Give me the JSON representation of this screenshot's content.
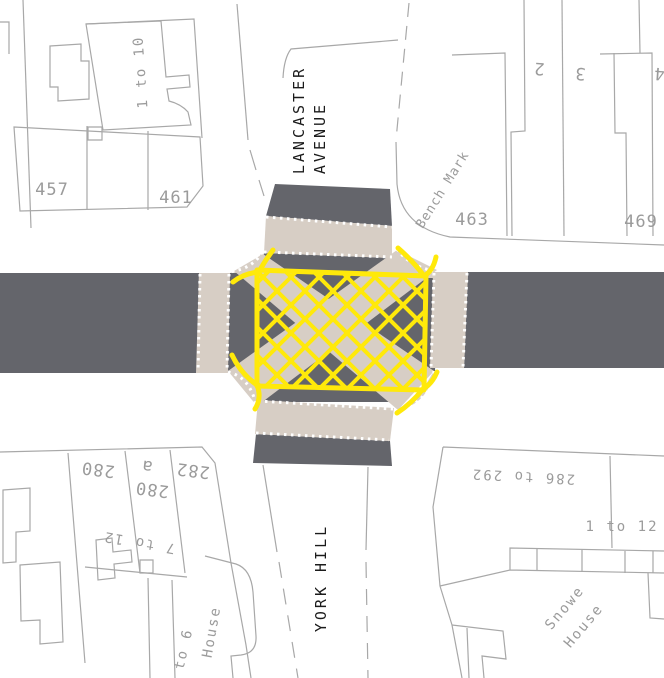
{
  "map_type": "large-scale street map of a crossroads with a yellow box junction",
  "streets": {
    "lancaster_line1": "LANCASTER",
    "lancaster_line2": "AVENUE",
    "york_hill": "YORK HILL"
  },
  "annotations": {
    "bench_mark": "Bench Mark"
  },
  "buildings": {
    "tl_range": "1 to 10",
    "n457": "457",
    "n461": "461",
    "n463": "463",
    "n469": "469",
    "n2": "2",
    "n3": "3",
    "n4": "4",
    "n280": "280",
    "n280a_num": "280",
    "n280a_suffix": "a",
    "n282": "282",
    "w_range": "7 to 12",
    "bl_range": "to 6",
    "bl_house": "House",
    "se_range": "286 to 292",
    "se_terrace_range": "1 to 12",
    "snowe_line1": "Snowe",
    "snowe_line2": "House"
  },
  "junction": {
    "marking": "box junction yellow crosshatch",
    "crossings": [
      "west",
      "north",
      "east",
      "south"
    ],
    "diagonal_crossings": [
      "northwest-southeast",
      "southwest-northeast"
    ]
  },
  "colors": {
    "road": "#64656b",
    "crossing": "#d7cec5",
    "box-yellow": "#ffe90a",
    "outline": "#a8a8a8",
    "label-grey": "#9b9b9b",
    "street-text": "#1b1b1b",
    "bg": "#ffffff",
    "dots": "#ffffff"
  }
}
